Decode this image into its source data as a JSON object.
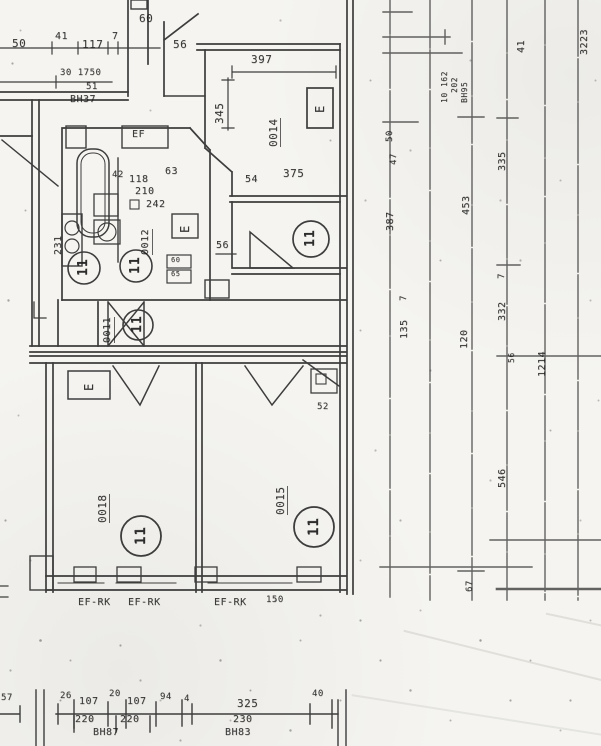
{
  "document": {
    "kind": "scanned architectural floor plan",
    "rooms": [
      "0011",
      "0012",
      "0014",
      "0015",
      "0018"
    ],
    "window_type_label": "EF-RK",
    "circled_position_number": "11"
  },
  "palette": {
    "paper": "#f5f4f0",
    "ink": "#2a2a2a"
  },
  "annotations": [
    {
      "name": "dim-250-cut",
      "text": "50",
      "x": 12,
      "y": 38,
      "size": 11
    },
    {
      "name": "dim-41",
      "text": "41",
      "x": 55,
      "y": 32,
      "size": 10
    },
    {
      "name": "dim-117",
      "text": "117",
      "x": 82,
      "y": 39,
      "size": 11
    },
    {
      "name": "dim-7",
      "text": "7",
      "x": 112,
      "y": 32,
      "size": 10
    },
    {
      "name": "dim-60",
      "text": "60",
      "x": 139,
      "y": 13,
      "size": 11
    },
    {
      "name": "dim-56-top",
      "text": "56",
      "x": 173,
      "y": 39,
      "size": 11
    },
    {
      "name": "dim-397",
      "text": "397",
      "x": 251,
      "y": 54,
      "size": 11
    },
    {
      "name": "note-30-1750",
      "text": "30 1750",
      "x": 60,
      "y": 69,
      "size": 9
    },
    {
      "name": "note-51",
      "text": "51",
      "x": 86,
      "y": 83,
      "size": 9
    },
    {
      "name": "note-bh37",
      "text": "BH37",
      "x": 70,
      "y": 95,
      "size": 10
    },
    {
      "name": "dim-42",
      "text": "42",
      "x": 112,
      "y": 171,
      "size": 9
    },
    {
      "name": "dim-118",
      "text": "118",
      "x": 129,
      "y": 175,
      "size": 10
    },
    {
      "name": "dim-63",
      "text": "63",
      "x": 165,
      "y": 167,
      "size": 10
    },
    {
      "name": "dim-210",
      "text": "210",
      "x": 135,
      "y": 187,
      "size": 10
    },
    {
      "name": "dim-242",
      "text": "242",
      "x": 146,
      "y": 200,
      "size": 10
    },
    {
      "name": "dim-54",
      "text": "54",
      "x": 245,
      "y": 175,
      "size": 10
    },
    {
      "name": "dim-375",
      "text": "375",
      "x": 283,
      "y": 168,
      "size": 11
    },
    {
      "name": "dim-56-mid",
      "text": "56",
      "x": 216,
      "y": 241,
      "size": 10
    },
    {
      "name": "dim-52",
      "text": "52",
      "x": 317,
      "y": 403,
      "size": 9
    },
    {
      "name": "label-ef",
      "text": "EF",
      "x": 132,
      "y": 130,
      "size": 10
    },
    {
      "name": "label-ef-rk-1",
      "text": "EF-RK",
      "x": 78,
      "y": 598,
      "size": 10
    },
    {
      "name": "label-ef-rk-2",
      "text": "EF-RK",
      "x": 128,
      "y": 598,
      "size": 10
    },
    {
      "name": "label-ef-rk-3",
      "text": "EF-RK",
      "x": 214,
      "y": 598,
      "size": 10
    },
    {
      "name": "dim-150",
      "text": "150",
      "x": 266,
      "y": 596,
      "size": 9
    },
    {
      "name": "dim-26",
      "text": "26",
      "x": 60,
      "y": 692,
      "size": 9
    },
    {
      "name": "dim-107a",
      "text": "107",
      "x": 79,
      "y": 697,
      "size": 10
    },
    {
      "name": "dim-20",
      "text": "20",
      "x": 109,
      "y": 690,
      "size": 9
    },
    {
      "name": "dim-107b",
      "text": "107",
      "x": 127,
      "y": 697,
      "size": 10
    },
    {
      "name": "dim-94",
      "text": "94",
      "x": 160,
      "y": 693,
      "size": 9
    },
    {
      "name": "dim-4",
      "text": "4",
      "x": 184,
      "y": 695,
      "size": 9
    },
    {
      "name": "dim-325",
      "text": "325",
      "x": 237,
      "y": 698,
      "size": 11
    },
    {
      "name": "dim-40",
      "text": "40",
      "x": 312,
      "y": 690,
      "size": 9
    },
    {
      "name": "dim-220a",
      "text": "220",
      "x": 75,
      "y": 715,
      "size": 10
    },
    {
      "name": "dim-220b",
      "text": "220",
      "x": 120,
      "y": 715,
      "size": 10
    },
    {
      "name": "dim-230",
      "text": "230",
      "x": 233,
      "y": 715,
      "size": 10
    },
    {
      "name": "note-bh87",
      "text": "BH87",
      "x": 93,
      "y": 728,
      "size": 10
    },
    {
      "name": "note-bh83",
      "text": "BH83",
      "x": 225,
      "y": 728,
      "size": 10
    },
    {
      "name": "dim-57-cut",
      "text": "57",
      "x": 1,
      "y": 694,
      "size": 9
    },
    {
      "name": "dim-60-small",
      "text": "60",
      "x": 171,
      "y": 257,
      "size": 7
    },
    {
      "name": "dim-65-small",
      "text": "65",
      "x": 171,
      "y": 271,
      "size": 7
    },
    {
      "name": "dim-345",
      "text": "345",
      "x": 214,
      "y": 124,
      "rot": 90,
      "size": 11
    },
    {
      "name": "room-0014",
      "text": "0014",
      "x": 268,
      "y": 147,
      "rot": 90,
      "size": 11,
      "cls": "room"
    },
    {
      "name": "dim-231",
      "text": "231",
      "x": 54,
      "y": 255,
      "rot": 90,
      "size": 10
    },
    {
      "name": "room-0012",
      "text": "0012",
      "x": 141,
      "y": 255,
      "rot": 90,
      "size": 10,
      "cls": "room"
    },
    {
      "name": "room-0011",
      "text": "0011",
      "x": 103,
      "y": 343,
      "rot": 90,
      "size": 10,
      "cls": "room"
    },
    {
      "name": "room-0018",
      "text": "0018",
      "x": 97,
      "y": 523,
      "rot": 90,
      "size": 11,
      "cls": "room"
    },
    {
      "name": "room-0015",
      "text": "0015",
      "x": 275,
      "y": 515,
      "rot": 90,
      "size": 11,
      "cls": "room"
    },
    {
      "name": "dim-3223",
      "text": "3223",
      "x": 580,
      "y": 55,
      "rot": 90,
      "size": 10
    },
    {
      "name": "dim-41-right",
      "text": "41",
      "x": 517,
      "y": 53,
      "rot": 90,
      "size": 10
    },
    {
      "name": "note-10-162",
      "text": "10 162",
      "x": 441,
      "y": 103,
      "rot": 90,
      "size": 8
    },
    {
      "name": "note-202",
      "text": "202",
      "x": 451,
      "y": 93,
      "rot": 90,
      "size": 8
    },
    {
      "name": "note-bh95",
      "text": "BH95",
      "x": 461,
      "y": 103,
      "rot": 90,
      "size": 8
    },
    {
      "name": "dim-50-right",
      "text": "50",
      "x": 386,
      "y": 142,
      "rot": 90,
      "size": 9
    },
    {
      "name": "dim-47-right",
      "text": "47",
      "x": 390,
      "y": 165,
      "rot": 90,
      "size": 9
    },
    {
      "name": "dim-387",
      "text": "387",
      "x": 386,
      "y": 231,
      "rot": 90,
      "size": 10
    },
    {
      "name": "dim-7a-right",
      "text": "7",
      "x": 400,
      "y": 301,
      "rot": 90,
      "size": 9
    },
    {
      "name": "dim-135",
      "text": "135",
      "x": 400,
      "y": 339,
      "rot": 90,
      "size": 10
    },
    {
      "name": "dim-453",
      "text": "453",
      "x": 462,
      "y": 215,
      "rot": 90,
      "size": 10
    },
    {
      "name": "dim-120",
      "text": "120",
      "x": 460,
      "y": 349,
      "rot": 90,
      "size": 10
    },
    {
      "name": "dim-335",
      "text": "335",
      "x": 498,
      "y": 171,
      "rot": 90,
      "size": 10
    },
    {
      "name": "dim-7b-right",
      "text": "7",
      "x": 498,
      "y": 279,
      "rot": 90,
      "size": 9
    },
    {
      "name": "dim-332",
      "text": "332",
      "x": 498,
      "y": 321,
      "rot": 90,
      "size": 10
    },
    {
      "name": "dim-56-right",
      "text": "56",
      "x": 508,
      "y": 363,
      "rot": 90,
      "size": 8
    },
    {
      "name": "dim-1214",
      "text": "1214",
      "x": 538,
      "y": 377,
      "rot": 90,
      "size": 10
    },
    {
      "name": "dim-546",
      "text": "546",
      "x": 498,
      "y": 488,
      "rot": 90,
      "size": 10
    },
    {
      "name": "dim-67",
      "text": "67",
      "x": 466,
      "y": 592,
      "rot": 90,
      "size": 9
    },
    {
      "name": "circled-11-bath-a",
      "text": "11",
      "x": 77,
      "y": 276,
      "rot": 90,
      "size": 13,
      "cls": "circ"
    },
    {
      "name": "circled-11-bath-b",
      "text": "11",
      "x": 129,
      "y": 274,
      "rot": 90,
      "size": 13,
      "cls": "circ"
    },
    {
      "name": "circled-11-corridor",
      "text": "11",
      "x": 131,
      "y": 333,
      "rot": 90,
      "size": 13,
      "cls": "circ"
    },
    {
      "name": "circled-11-room-mid",
      "text": "11",
      "x": 304,
      "y": 247,
      "rot": 90,
      "size": 13,
      "cls": "circ"
    },
    {
      "name": "circled-11-room-0018",
      "text": "11",
      "x": 134,
      "y": 545,
      "rot": 90,
      "size": 14,
      "cls": "circ"
    },
    {
      "name": "circled-11-room-0015",
      "text": "11",
      "x": 307,
      "y": 536,
      "rot": 90,
      "size": 14,
      "cls": "circ"
    },
    {
      "name": "label-e-0014",
      "text": "E",
      "x": 314,
      "y": 113,
      "rot": 90,
      "size": 12
    },
    {
      "name": "label-e-bath",
      "text": "E",
      "x": 179,
      "y": 233,
      "rot": 90,
      "size": 12
    },
    {
      "name": "label-e-0018",
      "text": "E",
      "x": 83,
      "y": 391,
      "rot": 90,
      "size": 12
    }
  ]
}
